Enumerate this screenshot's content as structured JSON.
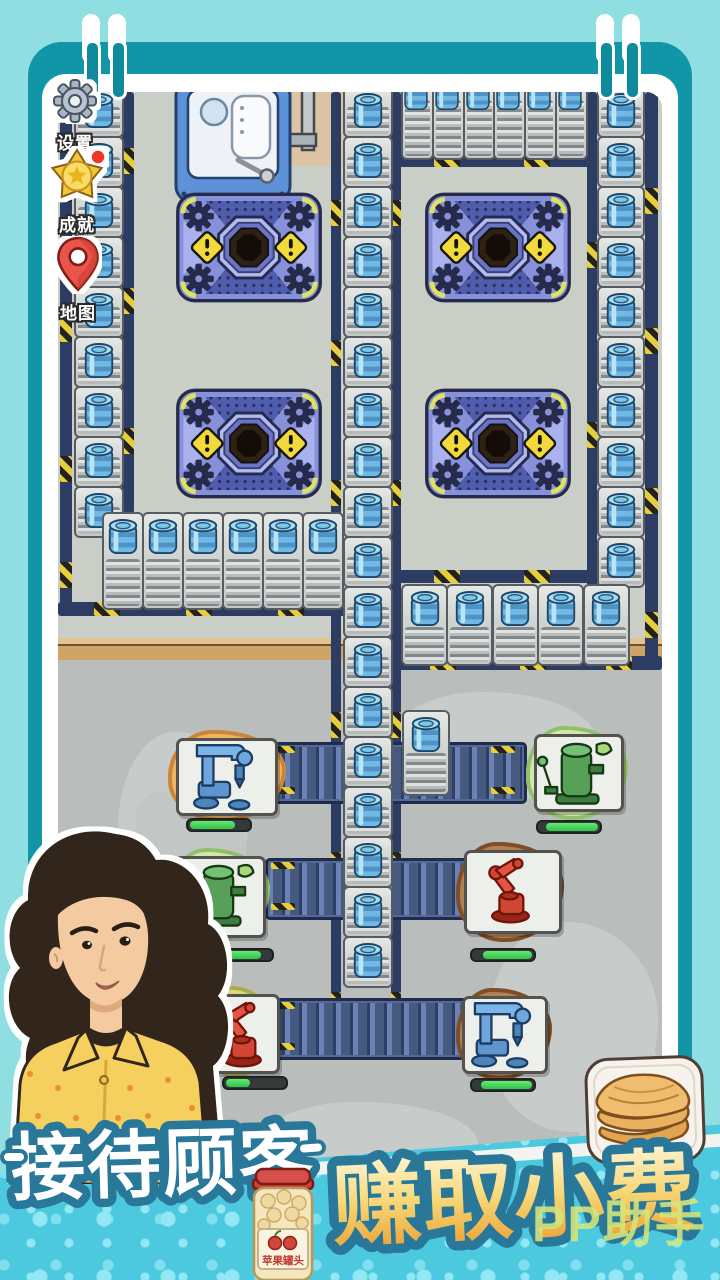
{
  "hud": {
    "settings_label": "设置",
    "achievements_label": "成就",
    "map_label": "地图",
    "achievement_alert": true
  },
  "banner": {
    "slogan_left": "接待顾客",
    "slogan_right": "赚取小费",
    "watermark": "PP助手",
    "jar_label": "苹果罐头"
  },
  "palette": {
    "page_bg": "#8fdfe2",
    "frame_dark": "#1295a6",
    "frame_white": "#ffffff",
    "floor_upper": "#c9cfc6",
    "floor_lower": "#b9bebd",
    "baseboard": "#d2a76e",
    "banner_bg": "#4dc9df",
    "banner_dot": "#8ce4f0",
    "slogan_outline": "#2a7899",
    "gold_top": "#fdf4d0",
    "gold_bottom": "#eb9c2e",
    "barrel": "#6fb9e4",
    "belt": "#46597e",
    "hazard_yellow": "#e8ce3a",
    "crusher_body": "#8791da",
    "progress_green": "#3ed85a"
  },
  "board": {
    "conveyors": {
      "left_column": 9,
      "middle_column": 18,
      "right_column": 10,
      "top_band_plates": 6,
      "top_band_barrels": 6,
      "left_bottom_row": 6,
      "right_bottom_row": 5,
      "mid_lower_row": 6,
      "short_column": 1
    },
    "crushers": [
      {
        "id": "crusher-1"
      },
      {
        "id": "crusher-2"
      },
      {
        "id": "crusher-3"
      },
      {
        "id": "crusher-4"
      }
    ],
    "machines": [
      {
        "id": "machine-drill-1",
        "kind": "drill",
        "patch": "sand",
        "progress": {
          "offset": 0,
          "value": 0.78
        }
      },
      {
        "id": "machine-boiler-1",
        "kind": "boiler",
        "patch": "grass",
        "progress": {
          "offset": 0.1,
          "value": 0.9
        }
      },
      {
        "id": "machine-boiler-2",
        "kind": "boiler",
        "patch": "grass",
        "progress": {
          "offset": 0,
          "value": 0.85
        }
      },
      {
        "id": "machine-robot-1",
        "kind": "robot",
        "patch": "dirt",
        "progress": {
          "offset": 0.15,
          "value": 0.85
        }
      },
      {
        "id": "machine-robot-2",
        "kind": "robot",
        "patch": "moss",
        "progress": {
          "offset": 0,
          "value": 0.42
        }
      },
      {
        "id": "machine-drill-2",
        "kind": "drill",
        "patch": "dirt",
        "progress": {
          "offset": 0.12,
          "value": 0.88
        }
      }
    ],
    "dispenser": {
      "id": "dispenser-1"
    }
  }
}
